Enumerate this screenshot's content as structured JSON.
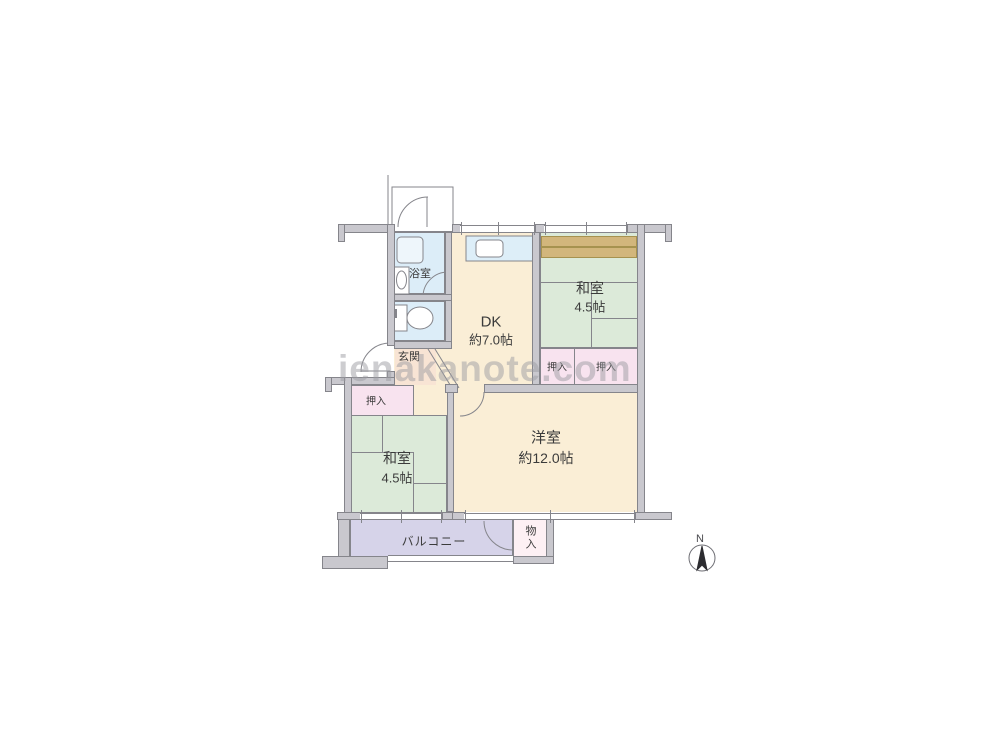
{
  "watermark": "ienakanote.com",
  "compass": {
    "north_label": "N"
  },
  "rooms": {
    "bathroom": {
      "label": "浴室"
    },
    "dining_kitchen": {
      "label": "DK",
      "size": "約7.0帖"
    },
    "japanese_room_upper": {
      "label": "和室",
      "size": "4.5帖"
    },
    "entrance": {
      "label": "玄関"
    },
    "closet_upper_left": {
      "label": "押入"
    },
    "closet_upper_right": {
      "label": "押入"
    },
    "closet_lower": {
      "label": "押入"
    },
    "japanese_room_lower": {
      "label": "和室",
      "size": "4.5帖"
    },
    "western_room": {
      "label": "洋室",
      "size": "約12.0帖"
    },
    "balcony": {
      "label": "バルコニー"
    },
    "storage": {
      "label": "物入"
    }
  },
  "colors": {
    "wall_fill": "#c9c8ce",
    "wall_border": "#85858b",
    "tatami_green": "#dcead9",
    "wood_floor_cream": "#faeed6",
    "closet_pink": "#f8e3ef",
    "wet_area_blue": "#dcedf8",
    "balcony_purple": "#d6d3e9",
    "entrance_peach": "#f8e4d4",
    "shelf_tan": "#d2b67c",
    "storage_white_pink": "#fdf0f4"
  }
}
